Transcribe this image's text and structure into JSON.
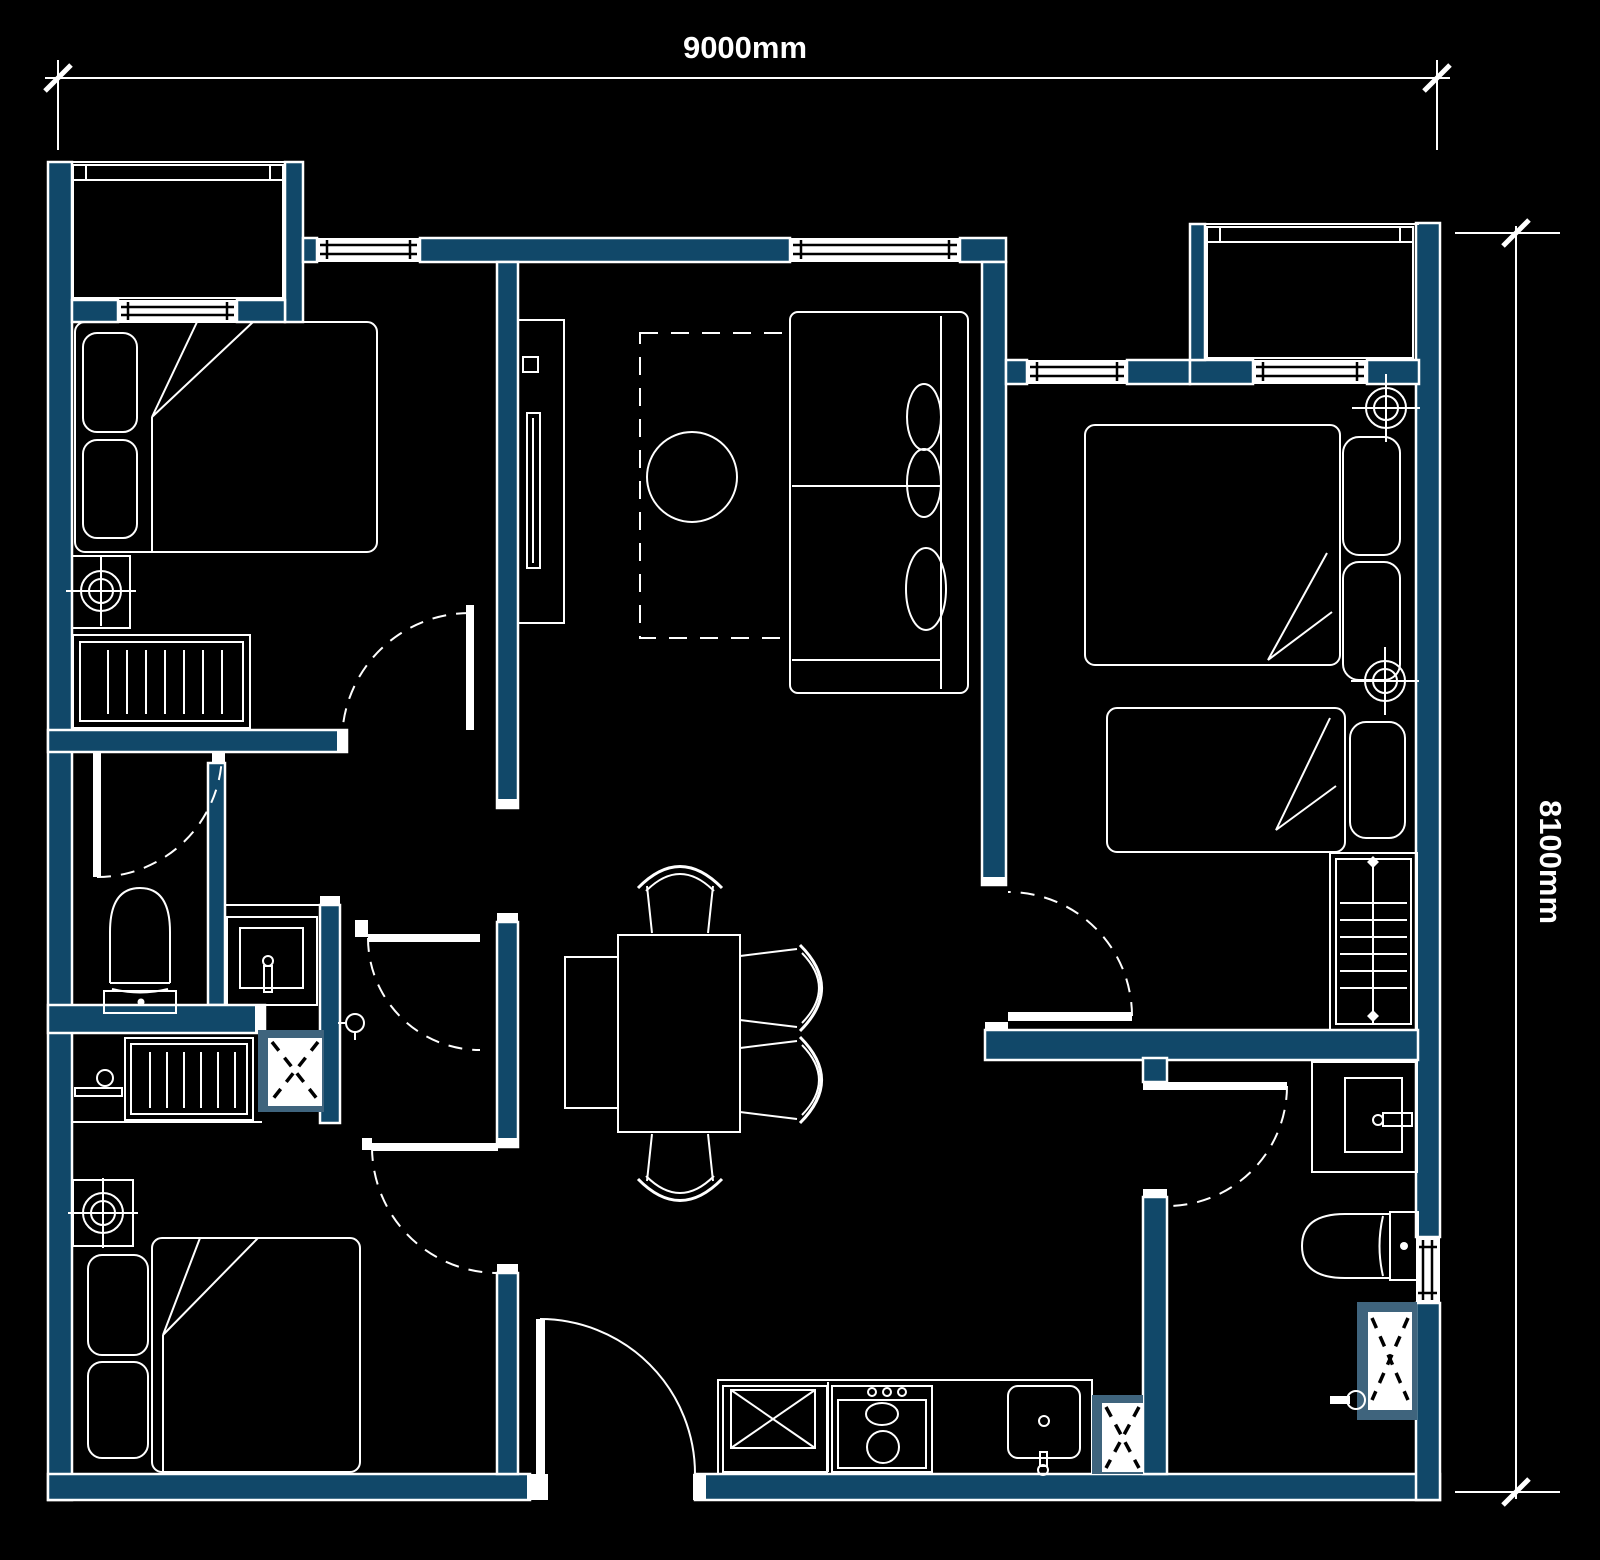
{
  "canvas": {
    "width": 1600,
    "height": 1560
  },
  "colors": {
    "background": "#000000",
    "wall": "#114869",
    "line": "#ffffff",
    "fixture_frame": "#3f647d"
  },
  "dimensions": {
    "horizontal": {
      "label": "9000mm"
    },
    "vertical": {
      "label": "8100mm"
    }
  },
  "fixtures": [
    "double-bed",
    "single-bed",
    "pillow",
    "duvet-fold",
    "ceiling-fan",
    "dresser",
    "wardrobe",
    "tv-unit",
    "rug",
    "coffee-table",
    "sofa",
    "dining-table",
    "dining-chair",
    "dining-bench",
    "toilet",
    "vanity-sink",
    "shower-tray",
    "shower-mixer",
    "towel-rail",
    "fridge",
    "stove",
    "kitchen-sink",
    "washing-machine",
    "balcony-unit",
    "window",
    "door-swing",
    "entry-door"
  ]
}
